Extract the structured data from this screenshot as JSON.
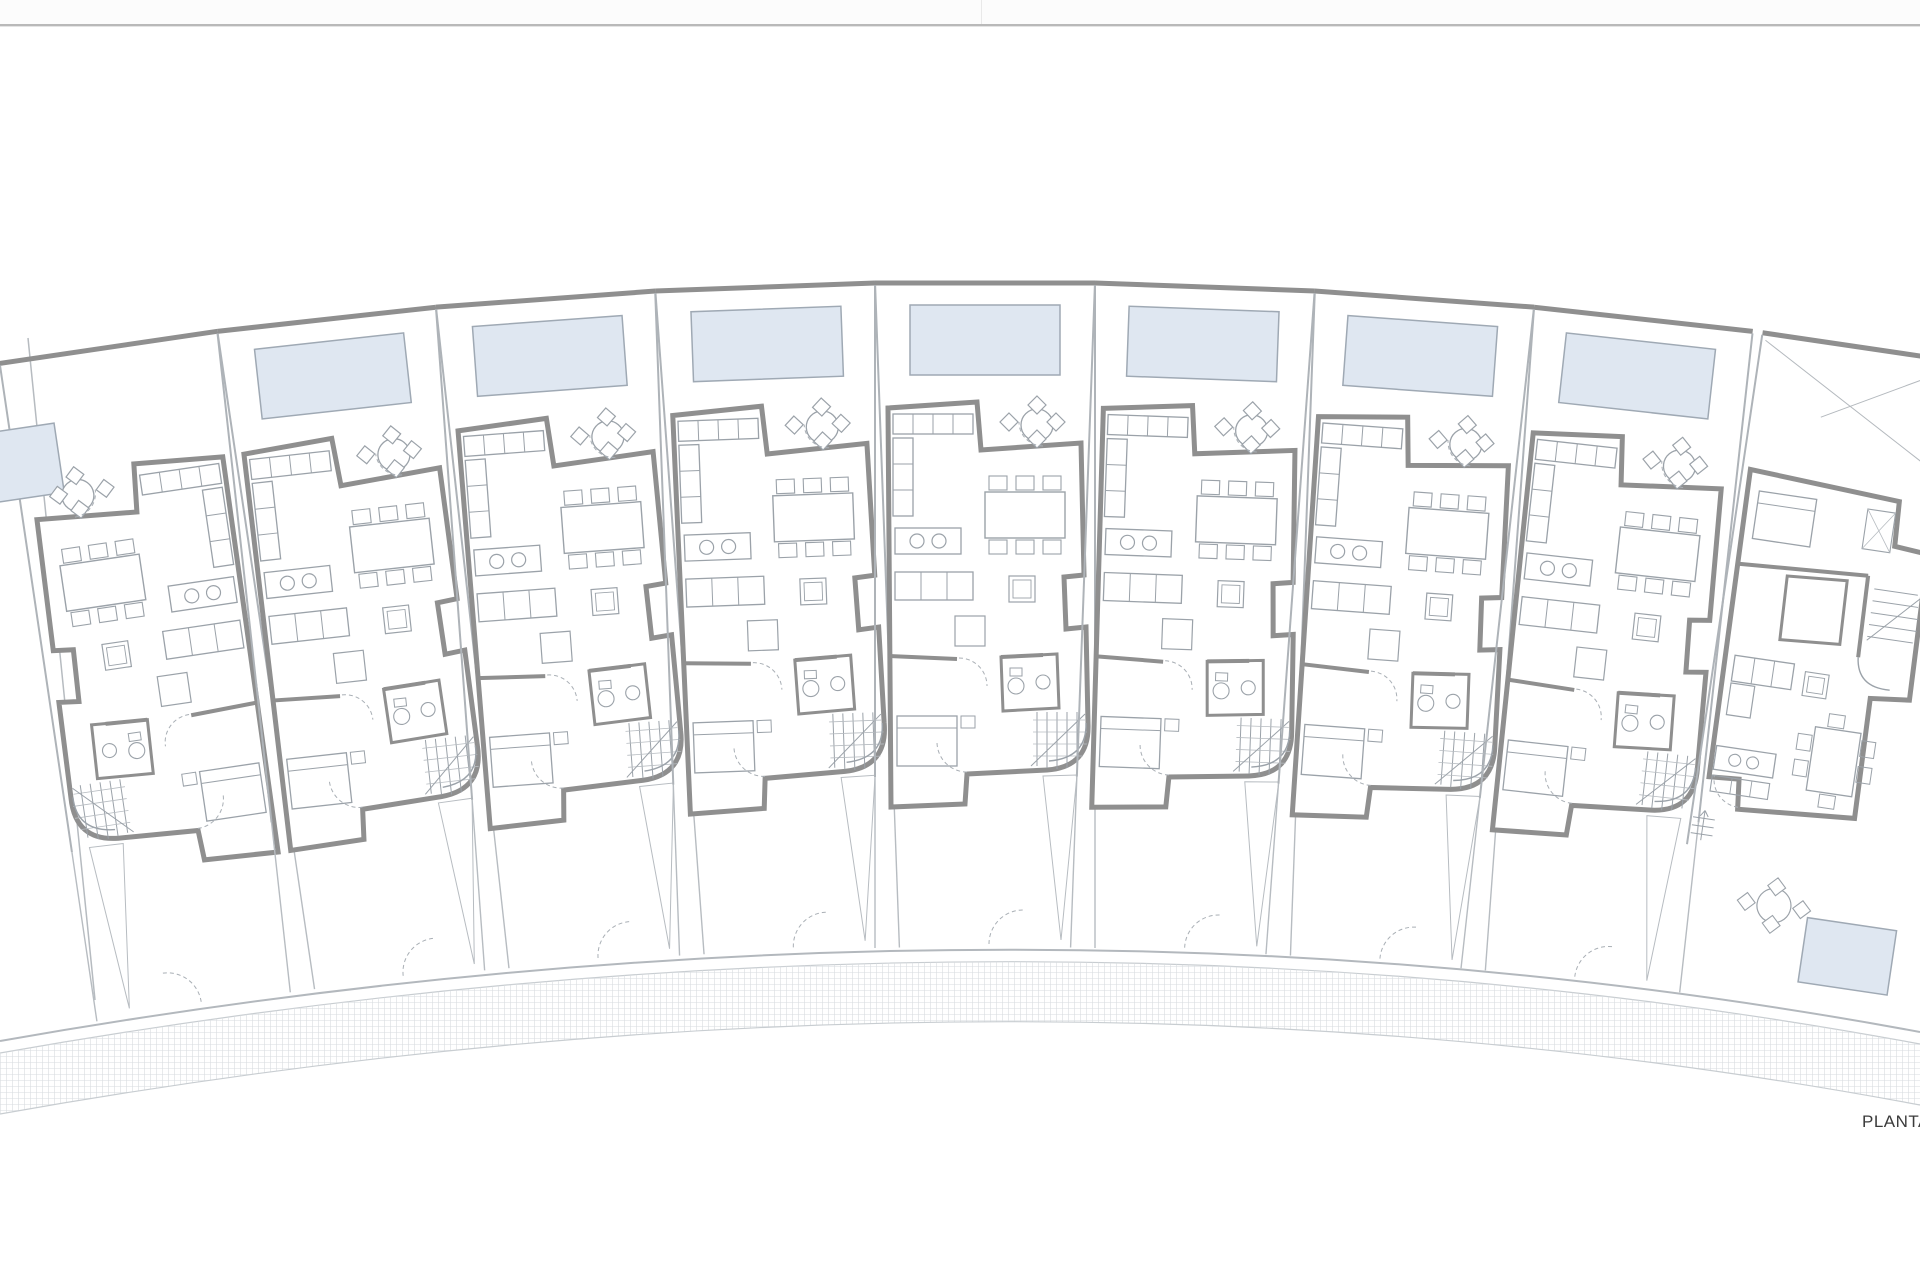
{
  "page": {
    "label": {
      "text": "PLANTA",
      "x": 1862,
      "y": 1112,
      "size": 17,
      "color": "#3b3b3b"
    }
  },
  "topbar": {
    "bg": "#fcfcfc",
    "bg_h": 24,
    "line_y": 24,
    "line_h": 2,
    "line_color": "#b9b9b9",
    "shadow_y": 26,
    "shadow_h": 1,
    "shadow_color": "#e4e4e4",
    "seam_x": 981,
    "seam_w": 1,
    "seam_h": 24,
    "seam_color": "#e9e9e9"
  },
  "plan": {
    "width": 1920,
    "height": 1280,
    "arc": {
      "cx": 985,
      "cy": 6280,
      "r": 6000
    },
    "colors": {
      "wall": "#8f8f8f",
      "furniture": "#9ba2a9",
      "light": "#b7bcc1",
      "dash": "#a9afb5",
      "pool_fill": "#dfe7f1",
      "pool_stroke": "#9fa9b4"
    },
    "hatch": {
      "id": "hatch",
      "size": 6,
      "d": "M 0 0.5 L 6 0.5 M 0.5 0 L 0.5 6",
      "color": "#d8dce0",
      "sw": 0.6
    },
    "ground": [
      {
        "t": "path",
        "d": "M 0 1041 Q 1010 863 1920 1032",
        "s": "#b3b8bd",
        "sw": 2
      },
      {
        "t": "path",
        "d": "M 0 1053 Q 1010 875 1920 1044",
        "s": "#c8cdd1",
        "sw": 1.2
      },
      {
        "t": "path",
        "d": "M 0 1053 Q 1010 875 1920 1044 L 1920 1105 Q 1010 934 0 1114 Z",
        "f": "url(#hatch)"
      },
      {
        "t": "path",
        "d": "M 0 1114 Q 1010 934 1920 1105",
        "s": "#c8cdd1",
        "sw": 1.2
      },
      {
        "t": "path",
        "d": "M 28 338 L 95 1000",
        "s": "#b6bbc0",
        "sw": 1.5
      }
    ],
    "units": [
      {
        "name": "unit-1",
        "variant": "standard",
        "angle_deg": -8.404,
        "flip": true,
        "pool_dx": 140,
        "pool_dy": 45
      },
      {
        "name": "unit-2",
        "variant": "standard",
        "angle_deg": -6.303
      },
      {
        "name": "unit-3",
        "variant": "standard",
        "angle_deg": -4.202
      },
      {
        "name": "unit-4",
        "variant": "standard",
        "angle_deg": -2.101
      },
      {
        "name": "unit-5",
        "variant": "standard",
        "angle_deg": 0
      },
      {
        "name": "unit-6",
        "variant": "standard",
        "angle_deg": 2.101
      },
      {
        "name": "unit-7",
        "variant": "standard",
        "angle_deg": 4.202
      },
      {
        "name": "unit-8",
        "variant": "standard",
        "angle_deg": 6.303
      },
      {
        "name": "unit-9",
        "variant": "end",
        "angle_deg": 8.404
      }
    ],
    "templates": {
      "standard": [
        {
          "t": "line",
          "x1": -110,
          "y1": 3,
          "x2": 110,
          "y2": 3,
          "s": "#8f8f8f",
          "sw": 5
        },
        {
          "t": "line",
          "x1": -110,
          "y1": 5,
          "x2": -110,
          "y2": 497,
          "s": "#aeb3b8",
          "sw": 2
        },
        {
          "t": "line",
          "x1": 110,
          "y1": 5,
          "x2": 110,
          "y2": 497,
          "s": "#aeb3b8",
          "sw": 2
        },
        {
          "t": "rect",
          "id": "pool",
          "x": -75,
          "y": 25,
          "w": 150,
          "h": 70,
          "f": "#dfe7f1",
          "s": "#9fa9b4",
          "sw": 1.5
        },
        {
          "t": "path",
          "d": "M -97 128 L -8 122 L -4 170 L 96 163 L 99 295 L 79 297 L 81 349 L 101 347 L 103 443 Q 105 487 62 490 L -18 494 L -20 524 L -94 527 Z",
          "f": "#ffffff",
          "s": "#8f8f8f",
          "sw": 5
        },
        {
          "t": "circle",
          "cx": 52,
          "cy": 145,
          "r": 16,
          "f": "#ffffff",
          "s": "#9ba2a9",
          "sw": 1.3
        },
        {
          "t": "path",
          "d": "M 52 116 l 9 9 l -9 9 l -9 -9 Z M 52 150 l 9 9 l -9 9 l -9 -9 Z M 24 133 l 9 9 l -9 9 l -9 -9 Z M 71 133 l 9 9 l -9 9 l -9 -9 Z",
          "f": "#ffffff",
          "s": "#9ba2a9",
          "sw": 1.2
        },
        {
          "t": "line",
          "x1": -96,
          "y1": 376,
          "x2": -28,
          "y2": 379,
          "s": "#8f8f8f",
          "sw": 4
        },
        {
          "t": "line",
          "x1": 16,
          "y1": 377,
          "x2": 58,
          "y2": 375,
          "s": "#8f8f8f",
          "sw": 4
        },
        {
          "t": "path",
          "d": "M 16 377 L 72 374 L 74 428 L 18 431 Z",
          "s": "#8f8f8f",
          "sw": 3
        },
        {
          "t": "rect",
          "x": -92,
          "y": 134,
          "w": 80,
          "h": 20,
          "s": "#9ba2a9",
          "sw": 1.3
        },
        {
          "t": "path",
          "d": "M -72 134 L -72 154 M -52 134 L -52 154 M -32 134 L -32 154",
          "s": "#9ba2a9",
          "sw": 1
        },
        {
          "t": "rect",
          "x": -92,
          "y": 158,
          "w": 20,
          "h": 78,
          "s": "#9ba2a9",
          "sw": 1.3
        },
        {
          "t": "path",
          "d": "M -92 184 L -72 184 M -92 210 L -72 210",
          "s": "#9ba2a9",
          "sw": 1
        },
        {
          "t": "rect",
          "x": -90,
          "y": 248,
          "w": 66,
          "h": 26,
          "s": "#9ba2a9",
          "sw": 1.3
        },
        {
          "t": "circle",
          "cx": -68,
          "cy": 261,
          "r": 7,
          "s": "#9ba2a9",
          "sw": 1.2
        },
        {
          "t": "circle",
          "cx": -46,
          "cy": 261,
          "r": 7,
          "s": "#9ba2a9",
          "sw": 1.2
        },
        {
          "t": "rect",
          "x": 0,
          "y": 212,
          "w": 80,
          "h": 46,
          "s": "#9ba2a9",
          "sw": 1.4
        },
        {
          "t": "rect",
          "x": 4,
          "y": 196,
          "w": 18,
          "h": 14,
          "s": "#9ba2a9",
          "sw": 1.1
        },
        {
          "t": "rect",
          "x": 31,
          "y": 196,
          "w": 18,
          "h": 14,
          "s": "#9ba2a9",
          "sw": 1.1
        },
        {
          "t": "rect",
          "x": 58,
          "y": 196,
          "w": 18,
          "h": 14,
          "s": "#9ba2a9",
          "sw": 1.1
        },
        {
          "t": "rect",
          "x": 4,
          "y": 260,
          "w": 18,
          "h": 14,
          "s": "#9ba2a9",
          "sw": 1.1
        },
        {
          "t": "rect",
          "x": 31,
          "y": 260,
          "w": 18,
          "h": 14,
          "s": "#9ba2a9",
          "sw": 1.1
        },
        {
          "t": "rect",
          "x": 58,
          "y": 260,
          "w": 18,
          "h": 14,
          "s": "#9ba2a9",
          "sw": 1.1
        },
        {
          "t": "rect",
          "x": -90,
          "y": 292,
          "w": 78,
          "h": 28,
          "s": "#9ba2a9",
          "sw": 1.3
        },
        {
          "t": "path",
          "d": "M -64 292 L -64 320 M -38 292 L -38 320",
          "s": "#9ba2a9",
          "sw": 1
        },
        {
          "t": "rect",
          "x": 24,
          "y": 296,
          "w": 26,
          "h": 26,
          "s": "#9ba2a9",
          "sw": 1.2
        },
        {
          "t": "rect",
          "x": 28,
          "y": 300,
          "w": 18,
          "h": 18,
          "s": "#9ba2a9",
          "sw": 0.9
        },
        {
          "t": "rect",
          "x": -30,
          "y": 336,
          "w": 30,
          "h": 30,
          "s": "#9ba2a9",
          "sw": 1.2
        },
        {
          "t": "rect",
          "x": 25,
          "y": 388,
          "w": 12,
          "h": 8,
          "s": "#9ba2a9",
          "sw": 1
        },
        {
          "t": "circle",
          "cx": 31,
          "cy": 406,
          "r": 8,
          "s": "#9ba2a9",
          "sw": 1.1
        },
        {
          "t": "circle",
          "cx": 58,
          "cy": 402,
          "r": 7,
          "s": "#9ba2a9",
          "sw": 1.1
        },
        {
          "t": "rect",
          "x": -88,
          "y": 436,
          "w": 60,
          "h": 50,
          "s": "#9ba2a9",
          "sw": 1.3
        },
        {
          "t": "path",
          "d": "M -88 448 L -28 448",
          "s": "#9ba2a9",
          "sw": 1
        },
        {
          "t": "rect",
          "x": -24,
          "y": 436,
          "w": 14,
          "h": 12,
          "s": "#9ba2a9",
          "sw": 1
        },
        {
          "t": "path",
          "d": "M 52 432 L 52 486 M 62 432 L 62 488 M 72 432 L 72 489 M 82 432 L 82 488 M 92 432 L 92 485",
          "s": "#9ba2a9",
          "sw": 1
        },
        {
          "t": "path",
          "d": "M 48 440 L 100 440 M 48 452 L 102 452 M 48 464 L 102 464 M 48 476 L 98 476",
          "s": "#b7bcc1",
          "sw": 0.8
        },
        {
          "t": "path",
          "d": "M 46 486 L 100 434",
          "s": "#9ba2a9",
          "sw": 1
        },
        {
          "t": "path",
          "d": "M 101 443 Q 102 478 64 481",
          "s": "#9ba2a9",
          "sw": 1.4
        },
        {
          "t": "path",
          "d": "M -26 378 A 28 28 0 0 1 2 406",
          "s": "#a9afb5",
          "sw": 1,
          "dash": "4 3"
        },
        {
          "t": "path",
          "d": "M -18 492 A 30 30 0 0 1 -48 462",
          "s": "#a9afb5",
          "sw": 1,
          "dash": "4 3"
        },
        {
          "t": "path",
          "d": "M 58 166 A 24 24 0 0 1 34 142",
          "s": "#a9afb5",
          "sw": 1,
          "dash": "4 3"
        },
        {
          "t": "line",
          "x1": -110,
          "y1": 497,
          "x2": -110,
          "y2": 668,
          "s": "#b7bcc1",
          "sw": 1.4
        },
        {
          "t": "line",
          "x1": 110,
          "y1": 497,
          "x2": 110,
          "y2": 668,
          "s": "#b7bcc1",
          "sw": 1.4
        },
        {
          "t": "path",
          "d": "M 58 496 L 92 495 L 76 660 Z",
          "s": "#b7bcc1",
          "sw": 1
        },
        {
          "t": "path",
          "d": "M 4 664 A 34 34 0 0 1 38 630",
          "s": "#a9afb5",
          "sw": 1,
          "dash": "4 3"
        }
      ],
      "end": [
        {
          "t": "line",
          "x1": -100,
          "y1": 3,
          "x2": 100,
          "y2": 3,
          "s": "#8f8f8f",
          "sw": 5
        },
        {
          "t": "line",
          "x1": -100,
          "y1": 5,
          "x2": -100,
          "y2": 520,
          "s": "#aeb3b8",
          "sw": 2
        },
        {
          "t": "path",
          "d": "M -96 10 L 98 120 M 98 8 L -30 78",
          "s": "#b4b9be",
          "sw": 1
        },
        {
          "t": "path",
          "d": "M -92 140 L 60 150 L 62 195 L 96 198 L 99 345 L 60 349 L 62 470 L -55 478 L -58 448 L -88 450 Z",
          "f": "#ffffff",
          "s": "#8f8f8f",
          "sw": 5
        },
        {
          "t": "line",
          "x1": -90,
          "y1": 235,
          "x2": 40,
          "y2": 228,
          "s": "#8f8f8f",
          "sw": 4
        },
        {
          "t": "path",
          "d": "M -40 240 L 20 236 L 22 300 L -38 304 Z",
          "s": "#8f8f8f",
          "sw": 3
        },
        {
          "t": "path",
          "d": "M 40 228 L 42 310",
          "s": "#8f8f8f",
          "sw": 4
        },
        {
          "t": "path",
          "d": "M 48 240 L 92 240 M 48 252 L 94 252 M 48 264 L 96 264 M 48 276 L 96 276 M 48 288 L 94 288",
          "s": "#9ba2a9",
          "sw": 1
        },
        {
          "t": "path",
          "d": "M 48 292 L 96 242",
          "s": "#9ba2a9",
          "sw": 1
        },
        {
          "t": "path",
          "d": "M 42 310 Q 45 340 78 338",
          "s": "#9ba2a9",
          "sw": 1.4
        },
        {
          "t": "rect",
          "x": -80,
          "y": 160,
          "w": 58,
          "h": 48,
          "s": "#9ba2a9",
          "sw": 1.3
        },
        {
          "t": "path",
          "d": "M -80 172 L -22 172",
          "s": "#9ba2a9",
          "sw": 1
        },
        {
          "t": "rect",
          "x": 30,
          "y": 162,
          "w": 28,
          "h": 40,
          "s": "#9ba2a9",
          "sw": 1.1
        },
        {
          "t": "path",
          "d": "M 30 162 L 58 202 M 58 162 L 30 202",
          "s": "#b7bcc1",
          "sw": 0.8
        },
        {
          "t": "rect",
          "x": -80,
          "y": 326,
          "w": 60,
          "h": 26,
          "s": "#9ba2a9",
          "sw": 1.3
        },
        {
          "t": "path",
          "d": "M -60 326 L -60 352 M -40 326 L -40 352",
          "s": "#9ba2a9",
          "sw": 1
        },
        {
          "t": "rect",
          "x": -80,
          "y": 354,
          "w": 24,
          "h": 32,
          "s": "#9ba2a9",
          "sw": 1.2
        },
        {
          "t": "rect",
          "x": -8,
          "y": 332,
          "w": 24,
          "h": 24,
          "s": "#9ba2a9",
          "sw": 1.1
        },
        {
          "t": "rect",
          "x": -4,
          "y": 336,
          "w": 16,
          "h": 16,
          "s": "#9ba2a9",
          "sw": 0.9
        },
        {
          "t": "rect",
          "x": -85,
          "y": 418,
          "w": 60,
          "h": 24,
          "s": "#9ba2a9",
          "sw": 1.3
        },
        {
          "t": "circle",
          "cx": -65,
          "cy": 430,
          "r": 6,
          "s": "#9ba2a9",
          "sw": 1.1
        },
        {
          "t": "circle",
          "cx": -47,
          "cy": 430,
          "r": 6,
          "s": "#9ba2a9",
          "sw": 1.1
        },
        {
          "t": "rect",
          "x": -85,
          "y": 448,
          "w": 58,
          "h": 16,
          "s": "#9ba2a9",
          "sw": 1.1
        },
        {
          "t": "path",
          "d": "M -65 448 L -65 464 M -45 448 L -45 464",
          "s": "#9ba2a9",
          "sw": 0.9
        },
        {
          "t": "rect",
          "x": 10,
          "y": 385,
          "w": 46,
          "h": 64,
          "s": "#9ba2a9",
          "sw": 1.3
        },
        {
          "t": "rect",
          "x": -6,
          "y": 394,
          "w": 14,
          "h": 16,
          "s": "#9ba2a9",
          "sw": 1
        },
        {
          "t": "rect",
          "x": -6,
          "y": 420,
          "w": 14,
          "h": 16,
          "s": "#9ba2a9",
          "sw": 1
        },
        {
          "t": "rect",
          "x": 58,
          "y": 392,
          "w": 14,
          "h": 16,
          "s": "#9ba2a9",
          "sw": 1
        },
        {
          "t": "rect",
          "x": 58,
          "y": 418,
          "w": 14,
          "h": 16,
          "s": "#9ba2a9",
          "sw": 1
        },
        {
          "t": "rect",
          "x": 22,
          "y": 370,
          "w": 16,
          "h": 13,
          "s": "#9ba2a9",
          "sw": 1
        },
        {
          "t": "rect",
          "x": 24,
          "y": 451,
          "w": 16,
          "h": 13,
          "s": "#9ba2a9",
          "sw": 1
        },
        {
          "t": "rect",
          "id": "pool",
          "x": 30,
          "y": 575,
          "w": 90,
          "h": 65,
          "f": "#dfe7f1",
          "s": "#9fa9b4",
          "sw": 1.5
        },
        {
          "t": "circle",
          "cx": -5,
          "cy": 568,
          "r": 17,
          "f": "#ffffff",
          "s": "#9ba2a9",
          "sw": 1.2
        },
        {
          "t": "path",
          "d": "M -5 540 l 9 9 l -9 9 l -9 -9 Z M -5 578 l 9 9 l -9 9 l -9 -9 Z M -33 559 l 9 9 l -9 9 l -9 -9 Z M 23 559 l 9 9 l -9 9 l -9 -9 Z",
          "f": "#ffffff",
          "s": "#9ba2a9",
          "sw": 1.1
        },
        {
          "t": "path",
          "d": "M -55 476 A 28 28 0 0 1 -83 448",
          "s": "#a9afb5",
          "sw": 1,
          "dash": "4 3"
        },
        {
          "t": "path",
          "d": "M -98 492 L -76 492 M -98 500 L -76 500 M -98 508 L -76 508",
          "s": "#9ba2a9",
          "sw": 1
        },
        {
          "t": "path",
          "d": "M -87 514 L -87 484 M -87 484 L -91 490 M -87 484 L -83 490",
          "s": "#9ba2a9",
          "sw": 1
        }
      ]
    }
  }
}
